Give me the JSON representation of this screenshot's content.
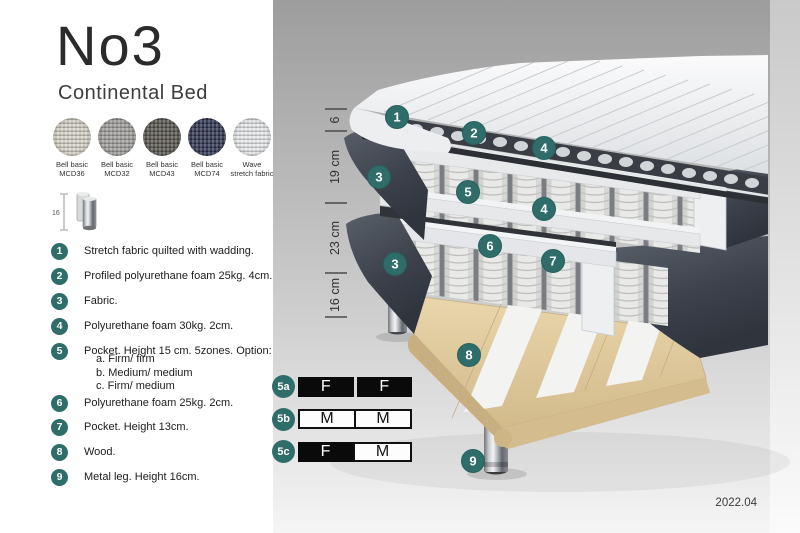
{
  "header": {
    "title": "No3",
    "subtitle": "Continental Bed"
  },
  "swatches": [
    {
      "line1": "Bell basic",
      "line2": "MCD36",
      "color": "#d7d3c8"
    },
    {
      "line1": "Bell basic",
      "line2": "MCD32",
      "color": "#a19f9c"
    },
    {
      "line1": "Bell basic",
      "line2": "MCD43",
      "color": "#57544e"
    },
    {
      "line1": "Bell basic",
      "line2": "MCD74",
      "color": "#2e3450"
    },
    {
      "line1": "Wave",
      "line2": "stretch fabric",
      "color": "#e9ebed"
    }
  ],
  "leg_icon": {
    "label": "16"
  },
  "legend": {
    "items": [
      {
        "num": "1",
        "text": "Stretch fabric quilted with wadding."
      },
      {
        "num": "2",
        "text": "Profiled polyurethane foam 25kg. 4cm."
      },
      {
        "num": "3",
        "text": "Fabric."
      },
      {
        "num": "4",
        "text": "Polyurethane foam 30kg. 2cm."
      },
      {
        "num": "5",
        "text": "Pocket. Height 15 cm. 5zones. Option:",
        "options": [
          "a. Firm/ firm",
          "b. Medium/ medium",
          "c. Firm/ medium"
        ]
      },
      {
        "num": "6",
        "text": "Polyurethane foam 25kg. 2cm."
      },
      {
        "num": "7",
        "text": "Pocket. Height 13cm."
      },
      {
        "num": "8",
        "text": "Wood."
      },
      {
        "num": "9",
        "text": "Metal leg. Height 16cm."
      }
    ]
  },
  "firmness_table": {
    "rows": [
      {
        "label": "5a",
        "cells": [
          {
            "text": "F"
          },
          {
            "text": "F"
          }
        ]
      },
      {
        "label": "5b",
        "cells": [
          {
            "text": "M"
          },
          {
            "text": "M"
          }
        ]
      },
      {
        "label": "5c",
        "cells": [
          {
            "text": "F"
          },
          {
            "text": "M"
          }
        ]
      }
    ]
  },
  "illustration": {
    "dimensions": [
      {
        "label": "6"
      },
      {
        "label": "19 cm"
      },
      {
        "label": "23 cm"
      },
      {
        "label": "16 cm"
      }
    ],
    "badges": [
      {
        "label": "1"
      },
      {
        "label": "2"
      },
      {
        "label": "4"
      },
      {
        "label": "3"
      },
      {
        "label": "5"
      },
      {
        "label": "4"
      },
      {
        "label": "6"
      },
      {
        "label": "7"
      },
      {
        "label": "3"
      },
      {
        "label": "8"
      },
      {
        "label": "9"
      }
    ],
    "version": "2022.04"
  },
  "colors": {
    "badge_teal": "#2f6d6a",
    "table_black": "#0a0a0a",
    "fabric_dark_gray": "#3c414b",
    "wood": "#ddc99c"
  }
}
